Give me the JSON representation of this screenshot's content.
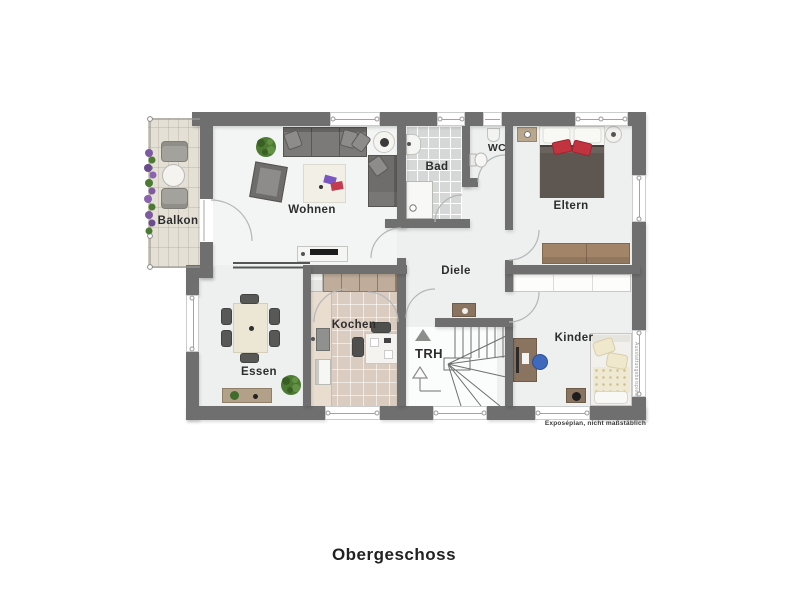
{
  "plan": {
    "title": "Obergeschoss",
    "disclaimer": "Exposéplan, nicht maßstäblich",
    "watermark": "Ausstattungsbeispiele",
    "rooms": {
      "balkon": "Balkon",
      "wohnen": "Wohnen",
      "bad": "Bad",
      "wc": "WC",
      "eltern": "Eltern",
      "diele": "Diele",
      "essen": "Essen",
      "kochen": "Kochen",
      "trh": "TRH",
      "kinder": "Kinder"
    },
    "colors": {
      "wall": "#6f6f6f",
      "floor": "#eef0f0",
      "bad_floor": "#d6d8d8",
      "kochen_floor": "#dbccc2",
      "balkon_floor": "#e4e0d6",
      "wood": "#a28568",
      "sofa_gray": "#6f6d6b",
      "accent_red": "#c1333f",
      "plant_green": "#4c7a33",
      "chair_blue": "#3f69bd"
    }
  }
}
